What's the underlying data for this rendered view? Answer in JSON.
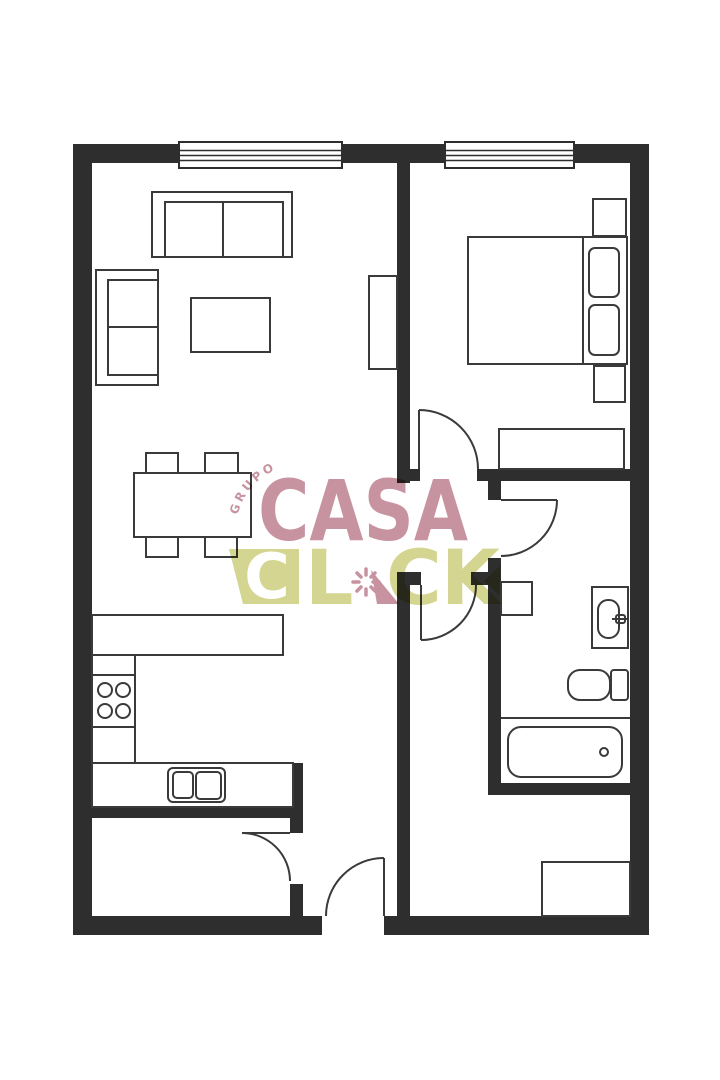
{
  "watermark": {
    "grupo": "GRUPO",
    "casa": "CASA",
    "click": {
      "c1": "C",
      "l": "L",
      "c2": "C",
      "k": "K"
    }
  },
  "colors": {
    "wall": "#2e2e2e",
    "line": "#3a3a3a",
    "rose": "#c58d9b",
    "olive": "#d2d38b",
    "bg": "#ffffff"
  },
  "fixtures": [
    "sofa",
    "loveseat",
    "coffee-table",
    "tv-console",
    "dining-table",
    "dining-chair",
    "kitchen-counter",
    "stove",
    "double-sink",
    "double-bed",
    "pillow",
    "nightstand",
    "wardrobe",
    "washer",
    "washbasin",
    "toilet",
    "bathtub",
    "hall-closet",
    "window",
    "door"
  ]
}
